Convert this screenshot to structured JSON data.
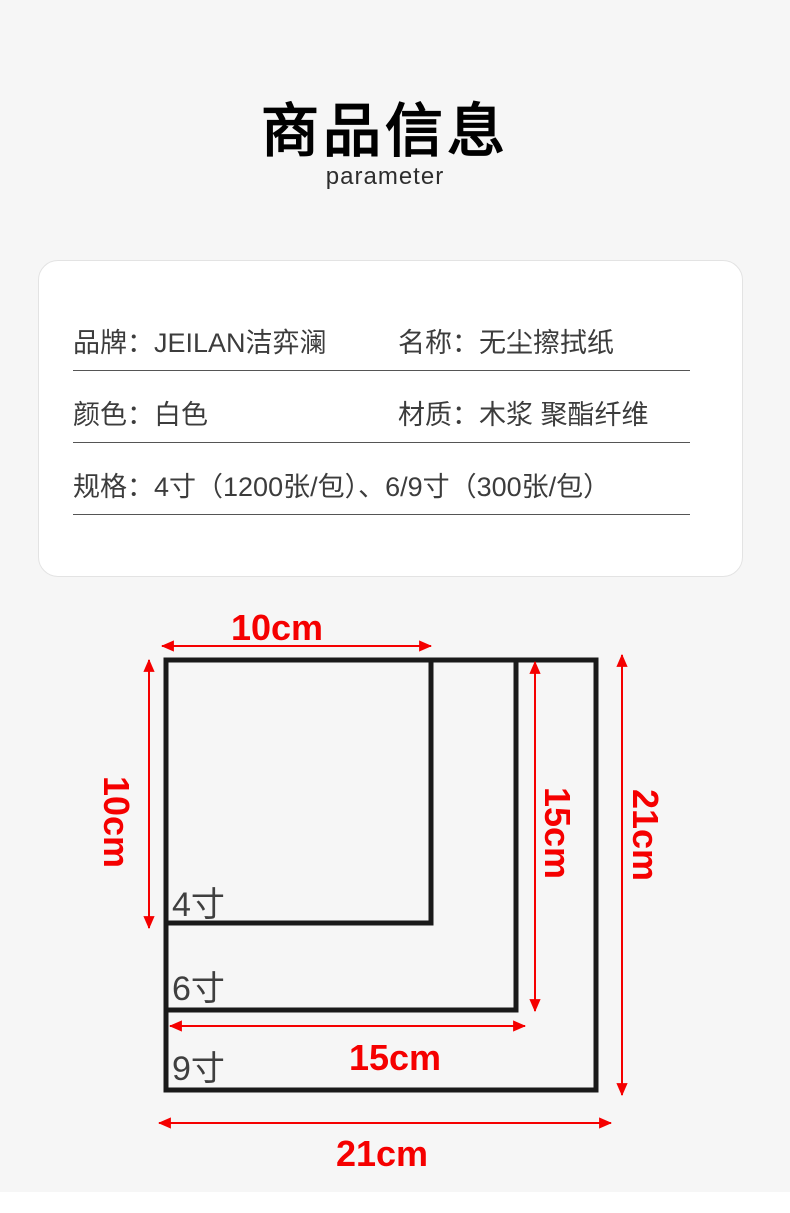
{
  "header": {
    "title": "商品信息",
    "subtitle": "parameter"
  },
  "info_table": {
    "rows": [
      {
        "cells": [
          {
            "label": "品牌：",
            "value": "JEILAN洁弈澜"
          },
          {
            "label": "名称：",
            "value": "无尘擦拭纸"
          }
        ]
      },
      {
        "cells": [
          {
            "label": "颜色：",
            "value": "白色"
          },
          {
            "label": "材质：",
            "value": "木浆 聚酯纤维"
          }
        ]
      },
      {
        "cells": [
          {
            "label": "规格：",
            "value": "4寸（1200张/包）、6/9寸（300张/包）"
          }
        ]
      }
    ]
  },
  "diagram": {
    "sizes": [
      {
        "name": "4寸",
        "width_label": "10cm",
        "height_label": "10cm"
      },
      {
        "name": "6寸",
        "width_label": "15cm",
        "height_label": "15cm"
      },
      {
        "name": "9寸",
        "width_label": "21cm",
        "height_label": "21cm"
      }
    ],
    "colors": {
      "dimension_red": "#f50000",
      "outline_black": "#1a1a1a",
      "size_label_gray": "#3f3f3f",
      "page_background": "#f6f6f6",
      "box_background": "#ffffff"
    }
  }
}
